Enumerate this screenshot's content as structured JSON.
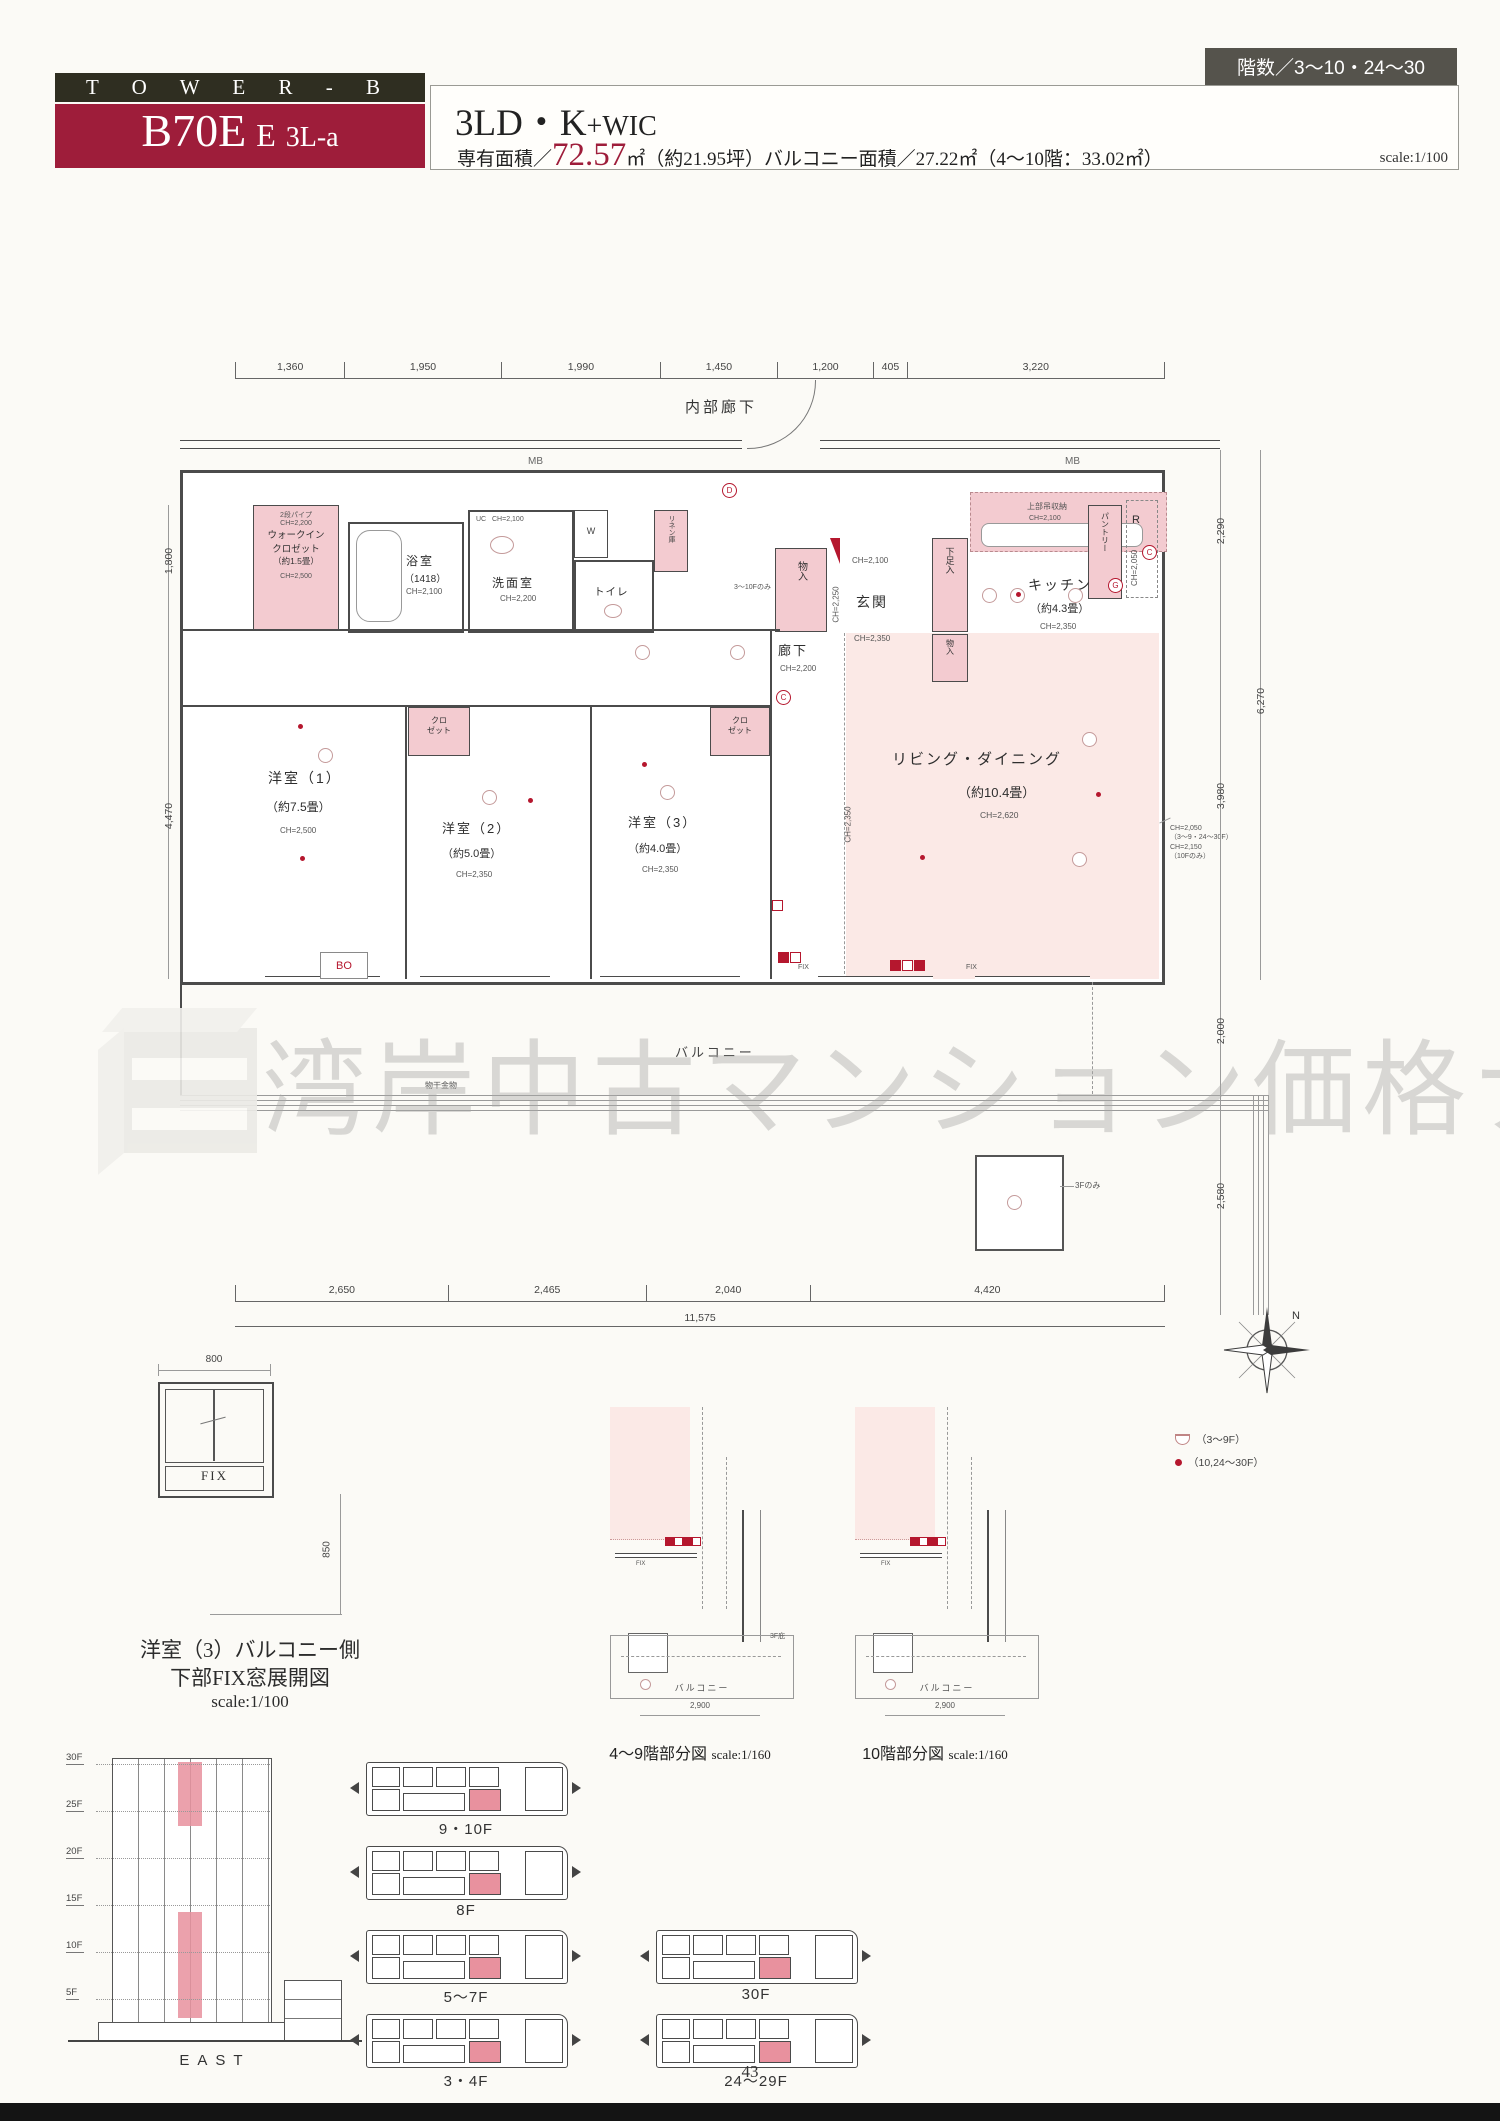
{
  "header": {
    "tower": "T O W E R - B",
    "unit_main": "B70E",
    "unit_sub": "E",
    "unit_type": "3L-a",
    "plan_name_main": "3LD・K",
    "plan_name_sub": "+WIC",
    "area_prefix": "専有面積／",
    "area_value": "72.57",
    "area_suffix": "㎡（約21.95坪）",
    "balcony_area": "バルコニー面積／27.22㎡（4〜10階：33.02㎡）",
    "scale": "scale:1/100",
    "floors_badge": "階数／3〜10・24〜30"
  },
  "plan": {
    "corridor_top": "内部廊下",
    "mb": "MB",
    "fix": "FIX",
    "bo": "BO",
    "balcony": "バルコニー",
    "hang_metal": "物干金物",
    "note_3f": "3Fのみ",
    "dims_top": [
      "1,360",
      "1,950",
      "1,990",
      "1,450",
      "1,200",
      "405",
      "3,220"
    ],
    "dims_bottom": [
      "2,650",
      "2,465",
      "2,040",
      "4,420"
    ],
    "dims_bottom_total": "11,575",
    "dims_left": [
      "1,800",
      "4,470"
    ],
    "dims_right": [
      "2,290",
      "6,270",
      "3,980",
      "2,000",
      "2,580"
    ],
    "wic": {
      "pipe": "2段パイプ",
      "ch_top": "CH=2,200",
      "name1": "ウォークイン",
      "name2": "クロゼット",
      "size": "（約1.5畳）",
      "ch": "CH=2,500"
    },
    "bath": {
      "name": "浴室",
      "size": "（1418）",
      "ch": "CH=2,100"
    },
    "wash": {
      "uc": "UC",
      "uc_ch": "CH=2,100",
      "name": "洗面室",
      "ch": "CH=2,200"
    },
    "toilet": {
      "name": "トイレ",
      "w": "W"
    },
    "linen": {
      "name": "リネン庫"
    },
    "mono": {
      "name": "物入"
    },
    "entry": {
      "ch_top": "CH=2,100",
      "name": "玄関",
      "shoe": "下足入",
      "ch_bottom": "CH=2,350",
      "ch_side": "CH=2,250",
      "note": "3〜10Fのみ"
    },
    "kitchen": {
      "hang": "上部吊収納",
      "hang_ch": "CH=2,100",
      "pantry": "パントリー",
      "r": "R",
      "r_ch": "CH=2,050",
      "name": "キッチン",
      "size": "（約4.3畳）",
      "ch": "CH=2,350"
    },
    "corridor": {
      "name": "廊下",
      "ch": "CH=2,200"
    },
    "room1": {
      "name": "洋室（1）",
      "size": "（約7.5畳）",
      "ch": "CH=2,500"
    },
    "room2": {
      "name": "洋室（2）",
      "size": "（約5.0畳）",
      "ch": "CH=2,350"
    },
    "room3": {
      "name": "洋室（3）",
      "size": "（約4.0畳）",
      "ch": "CH=2,350"
    },
    "living": {
      "name": "リビング・ダイニング",
      "size": "（約10.4畳）",
      "ch": "CH=2,620",
      "ch_side": "CH=2,350",
      "note1": "CH=2,050",
      "note2": "（3〜9・24〜30F）",
      "note3": "CH=2,150",
      "note4": "（10Fのみ）"
    },
    "closet": {
      "l1": "クロ",
      "l2": "ゼット"
    },
    "markers": {
      "d": "D",
      "c": "C",
      "g": "G"
    }
  },
  "watermark": {
    "text": "湾岸中古マンション価格ナビ"
  },
  "fixwin": {
    "dim_w": "800",
    "dim_h": "850",
    "fix": "FIX",
    "cap1": "洋室（3）バルコニー側",
    "cap2": "下部FIX窓展開図",
    "scale": "scale:1/100"
  },
  "elevation": {
    "floors": [
      "30F",
      "25F",
      "20F",
      "15F",
      "10F",
      "5F"
    ],
    "caption": "EAST"
  },
  "keyplans": {
    "labels": [
      "9・10F",
      "8F",
      "5〜7F",
      "3・4F",
      "30F",
      "24〜29F"
    ]
  },
  "partials": [
    {
      "caption": "4〜9階部分図",
      "scale": "scale:1/160",
      "balcony": "バルコニー",
      "dim": "2,900",
      "note": "3F庇",
      "fix": "FIX"
    },
    {
      "caption": "10階部分図",
      "scale": "scale:1/160",
      "balcony": "バルコニー",
      "dim": "2,900",
      "note": "",
      "fix": "FIX"
    }
  ],
  "legend": {
    "item1": "（3〜9F）",
    "item2": "（10,24〜30F）"
  },
  "compass": {
    "north": "N"
  },
  "footer": {
    "page": "43"
  },
  "colors": {
    "accent_red": "#9e1d3a",
    "header_olive": "#2f2e21",
    "pink_fill": "#f3cbd0",
    "pink_light": "#fbe9e6",
    "marker_red": "#b5172e"
  }
}
